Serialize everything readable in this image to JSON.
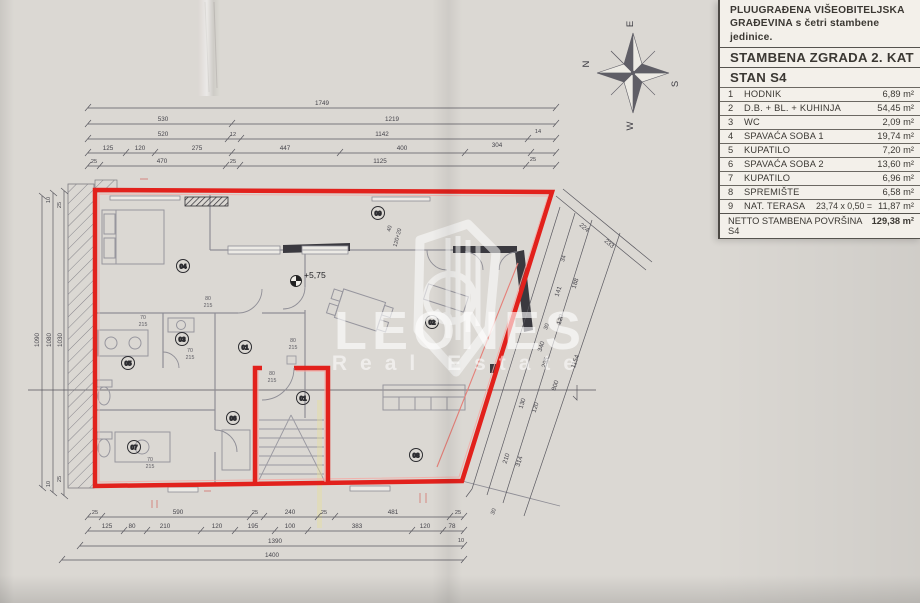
{
  "legend": {
    "header_line1": "PLUUGRAĐENA VIŠEOBITELJSKA",
    "header_line2": "GRAĐEVINA s četri stambene jedinice.",
    "building": "STAMBENA ZGRADA 2. KAT",
    "unit": "STAN S4",
    "rows": [
      {
        "num": "1",
        "name": "HODNIK",
        "area": "6,89 m²"
      },
      {
        "num": "2",
        "name": "D.B. + BL. + KUHINJA",
        "area": "54,45 m²"
      },
      {
        "num": "3",
        "name": "WC",
        "area": "2,09 m²"
      },
      {
        "num": "4",
        "name": "SPAVAĆA SOBA 1",
        "area": "19,74 m²"
      },
      {
        "num": "5",
        "name": "KUPATILO",
        "area": "7,20 m²"
      },
      {
        "num": "6",
        "name": "SPAVAĆA SOBA 2",
        "area": "13,60 m²"
      },
      {
        "num": "7",
        "name": "KUPATILO",
        "area": "6,96 m²"
      },
      {
        "num": "8",
        "name": "SPREMIŠTE",
        "area": "6,58 m²"
      },
      {
        "num": "9",
        "name": "NAT. TERASA",
        "formula": "23,74 x 0,50 =",
        "area": "11,87 m²"
      }
    ],
    "total_label": "NETTO STAMBENA POVRŠINA S4",
    "total_area": "129,38 m²"
  },
  "compass": {
    "n": "N",
    "e": "E",
    "s": "S",
    "w": "W"
  },
  "watermark": {
    "brand": "LEONES",
    "sub": "Real Estate"
  },
  "plan": {
    "elevation": "+5,75",
    "room_markers": [
      {
        "id": "04"
      },
      {
        "id": "09"
      },
      {
        "id": "02"
      },
      {
        "id": "03"
      },
      {
        "id": "01"
      },
      {
        "id": "05"
      },
      {
        "id": "06"
      },
      {
        "id": "01"
      },
      {
        "id": "07"
      },
      {
        "id": "08"
      }
    ],
    "door_labels": [
      {
        "w": "70",
        "h": "215"
      },
      {
        "w": "70",
        "h": "215"
      },
      {
        "w": "80",
        "h": "215"
      },
      {
        "w": "80",
        "h": "215"
      },
      {
        "w": "70",
        "h": "215"
      },
      {
        "w": "80",
        "h": "215"
      }
    ],
    "dims": {
      "top1": [
        "1749"
      ],
      "top2": [
        "530",
        "1219"
      ],
      "top3": [
        "520",
        "12",
        "1142",
        "14"
      ],
      "top4": [
        "125",
        "120",
        "275",
        "447",
        "400",
        "304"
      ],
      "top5": [
        "25",
        "470",
        "25",
        "1125",
        "25"
      ],
      "bottom1": [
        "25",
        "590",
        "25",
        "240",
        "25",
        "481",
        "25"
      ],
      "bottom2": [
        "125",
        "80",
        "210",
        "120",
        "195",
        "100",
        "383",
        "120",
        "78"
      ],
      "bottom3": [
        "1390",
        "10"
      ],
      "bottom4": [
        "1400"
      ],
      "left": [
        "1090",
        "1080",
        "1030"
      ],
      "left_small": [
        "10",
        "25",
        "10",
        "25"
      ],
      "diag": [
        "224",
        "233",
        "34",
        "188",
        "141",
        "120",
        "30",
        "340",
        "295",
        "800",
        "1154",
        "130",
        "120",
        "210",
        "314",
        "30"
      ],
      "inner": [
        "40",
        "120+20"
      ]
    }
  }
}
